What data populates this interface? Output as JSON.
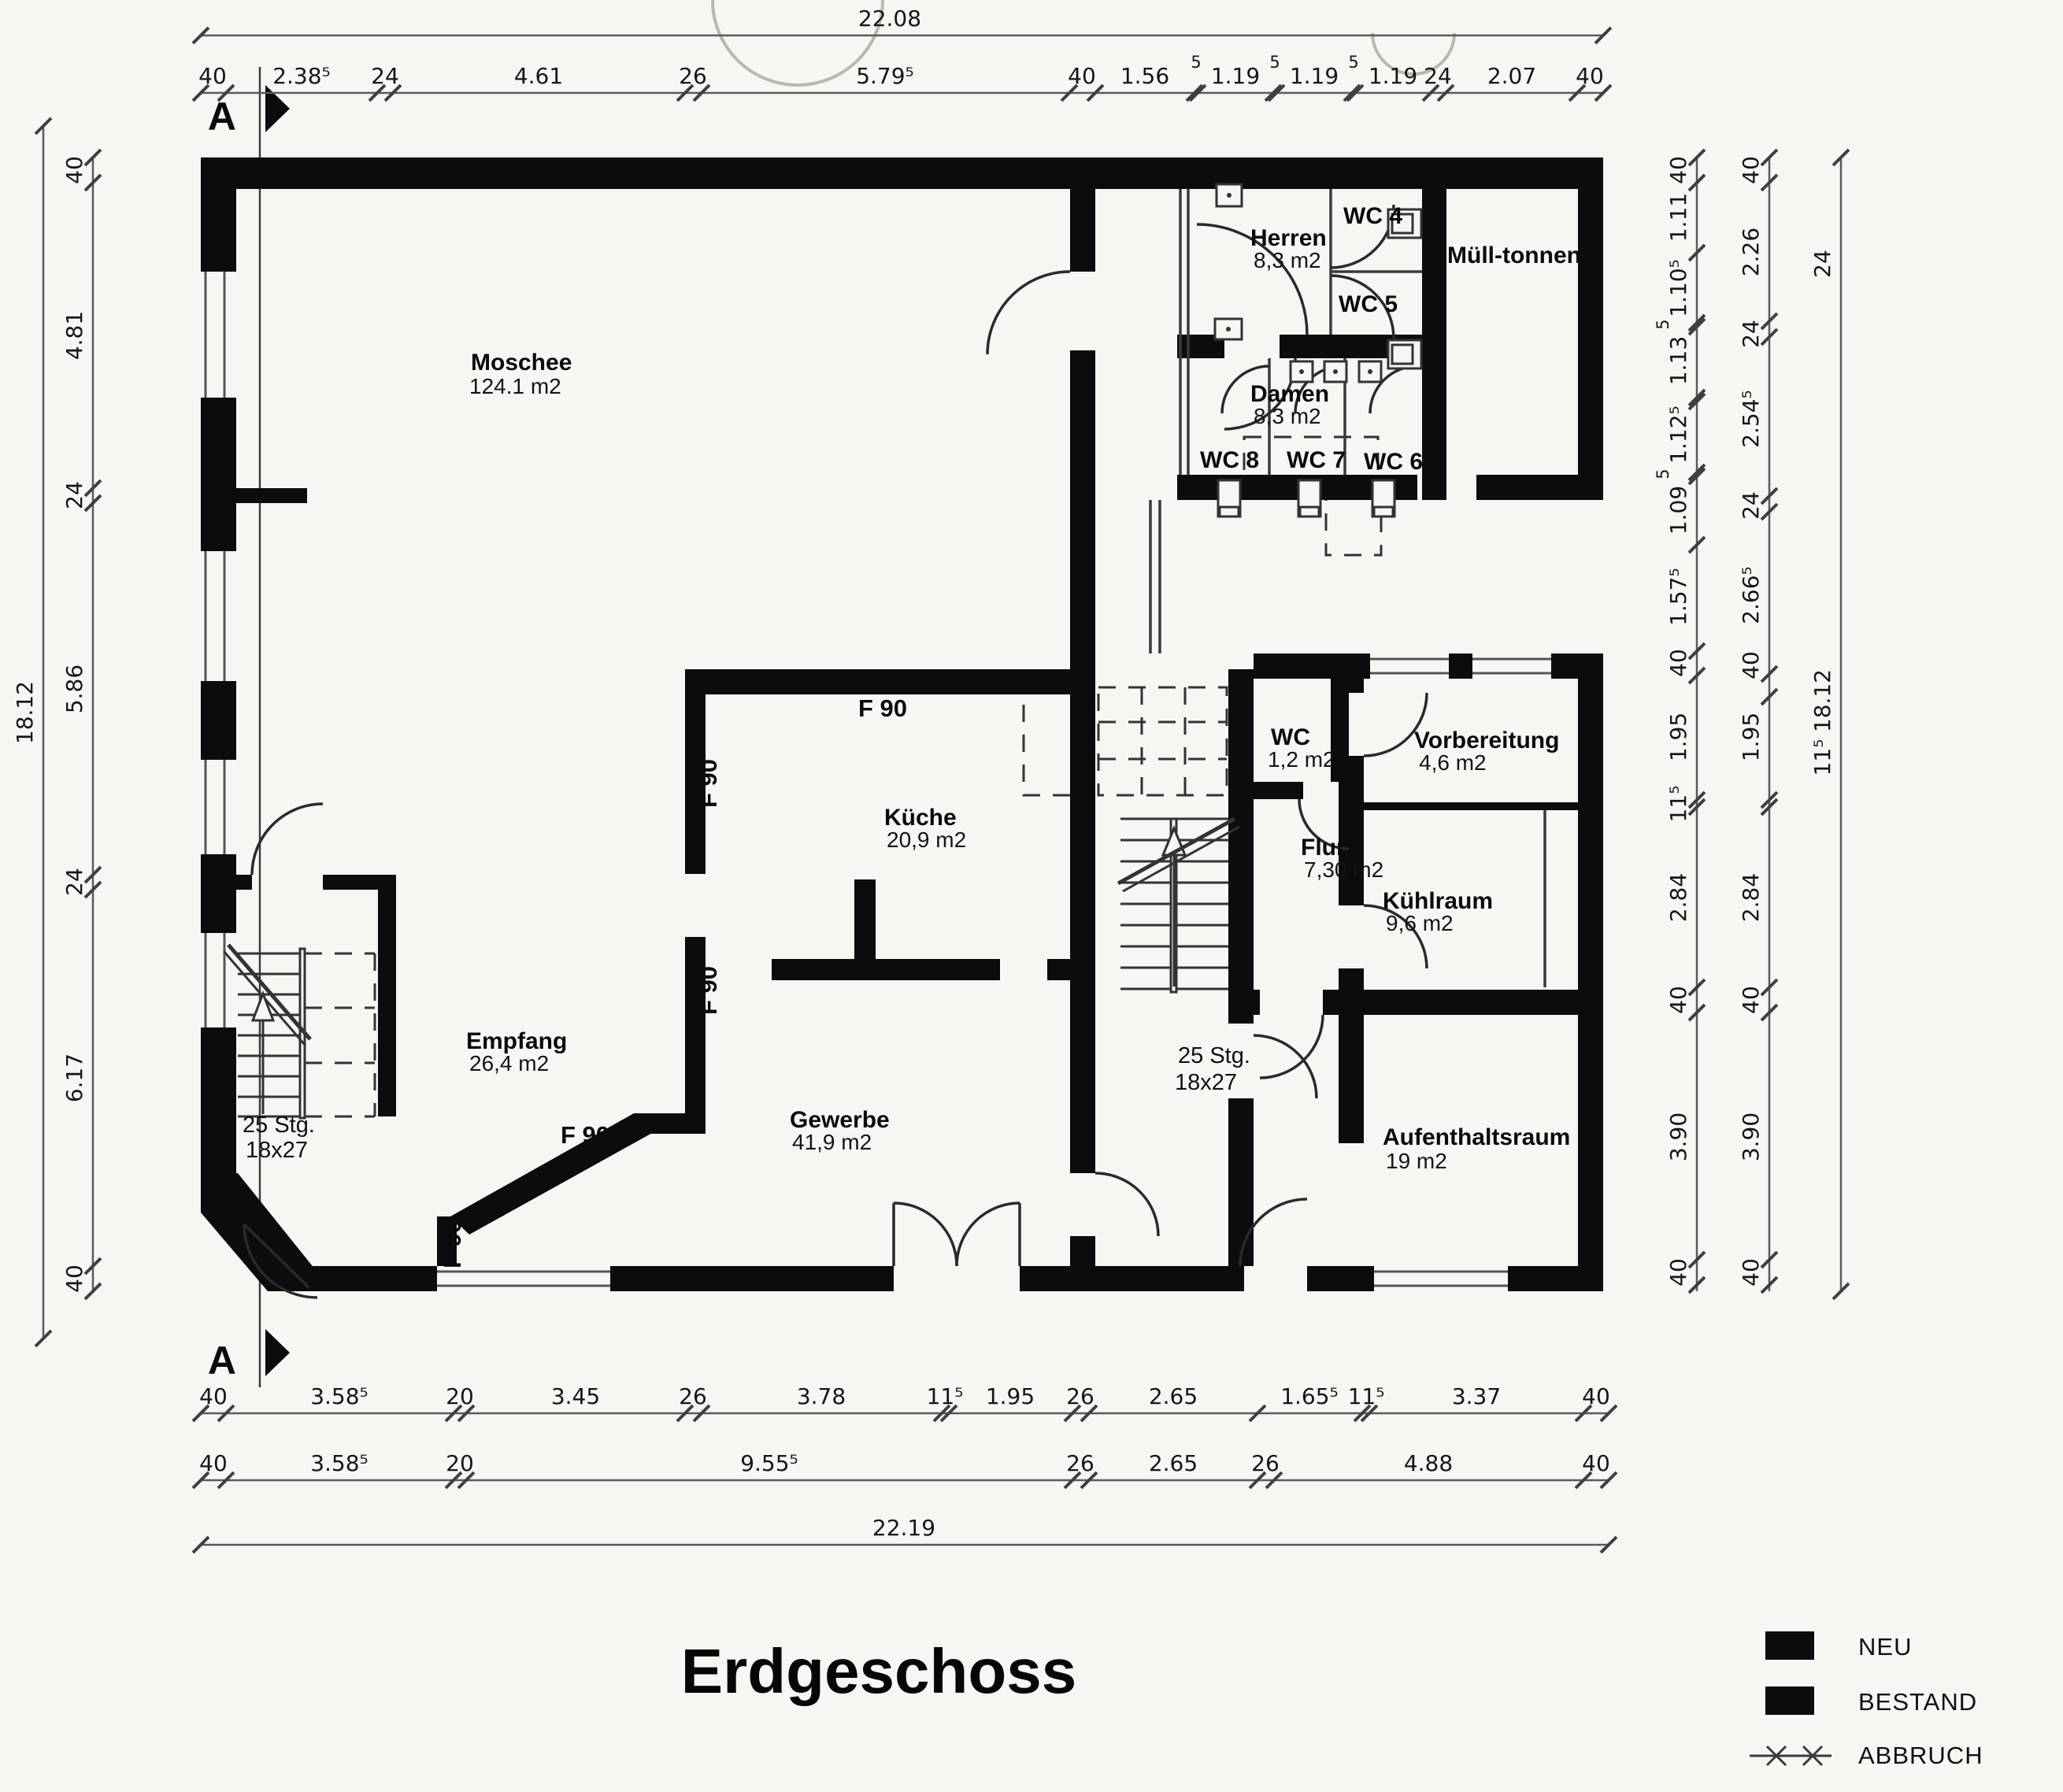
{
  "plan_title": "Erdgeschoss",
  "section_marker": {
    "label": "A"
  },
  "rooms": {
    "moschee": {
      "name": "Moschee",
      "area": "124.1 m2"
    },
    "herren": {
      "name": "Herren",
      "area": "8,3 m2"
    },
    "wc4": {
      "name": "WC 4"
    },
    "wc5": {
      "name": "WC 5"
    },
    "muelltonnen": {
      "name": "Müll-tonnen"
    },
    "damen": {
      "name": "Damen",
      "area": "8,3 m2"
    },
    "wc8": {
      "name": "WC 8"
    },
    "wc7": {
      "name": "WC 7"
    },
    "wc6": {
      "name": "WC 6"
    },
    "kueche": {
      "name": "Küche",
      "area": "20,9 m2"
    },
    "wc": {
      "name": "WC",
      "area": "1,2 m2"
    },
    "flur": {
      "name": "Flur",
      "area": "7,30 m2"
    },
    "vorbereitung": {
      "name": "Vorbereitung",
      "area": "4,6 m2"
    },
    "kuehlraum": {
      "name": "Kühlraum",
      "area": "9,6 m2"
    },
    "aufenthaltsraum": {
      "name": "Aufenthaltsraum",
      "area": "19 m2"
    },
    "empfang": {
      "name": "Empfang",
      "area": "26,4 m2"
    },
    "gewerbe": {
      "name": "Gewerbe",
      "area": "41,9 m2"
    }
  },
  "stairs": {
    "label_steps": "25 Stg.",
    "label_size": "18x27"
  },
  "fire_rating": "F 90",
  "legend": {
    "neu": "NEU",
    "bestand": "BESTAND",
    "abbruch": "ABBRUCH"
  },
  "colors": {
    "wall": "#0c0c0c",
    "paper": "#f7f6f2"
  },
  "dim_chains": [
    {
      "id": "top-total",
      "dir": "h",
      "line": 45,
      "range": [
        255,
        2036
      ],
      "ticks": [
        255,
        2036
      ],
      "labels": [
        {
          "t": "22.08",
          "p": 1130
        }
      ]
    },
    {
      "id": "top-chain",
      "dir": "h",
      "line": 118,
      "range": [
        255,
        2036
      ],
      "ticks": [
        255,
        287,
        479,
        499,
        870,
        891,
        1358,
        1391,
        1517,
        1521,
        1617,
        1621,
        1717,
        1721,
        1817,
        1836,
        2003,
        2036
      ],
      "labels": [
        {
          "t": "40",
          "p": 270
        },
        {
          "t": "2.38⁵",
          "p": 383
        },
        {
          "t": "24",
          "p": 489
        },
        {
          "t": "4.61",
          "p": 684
        },
        {
          "t": "26",
          "p": 880
        },
        {
          "t": "5.79⁵",
          "p": 1124
        },
        {
          "t": "40",
          "p": 1374
        },
        {
          "t": "1.56",
          "p": 1454
        },
        {
          "t": "5",
          "p": 1519,
          "small": 1
        },
        {
          "t": "1.19",
          "p": 1569
        },
        {
          "t": "5",
          "p": 1619,
          "small": 1
        },
        {
          "t": "1.19",
          "p": 1669
        },
        {
          "t": "5",
          "p": 1719,
          "small": 1
        },
        {
          "t": "1.19",
          "p": 1769
        },
        {
          "t": "24",
          "p": 1826
        },
        {
          "t": "2.07",
          "p": 1920
        },
        {
          "t": "40",
          "p": 2019
        }
      ]
    },
    {
      "id": "bottom-chain-1",
      "dir": "h",
      "line": 1795,
      "range": [
        255,
        2043
      ],
      "ticks": [
        255,
        287,
        576,
        592,
        870,
        891,
        1196,
        1205,
        1362,
        1383,
        1597,
        1730,
        1739,
        2011,
        2043
      ],
      "labels": [
        {
          "t": "40",
          "p": 271
        },
        {
          "t": "3.58⁵",
          "p": 431
        },
        {
          "t": "20",
          "p": 584
        },
        {
          "t": "3.45",
          "p": 731
        },
        {
          "t": "26",
          "p": 880
        },
        {
          "t": "3.78",
          "p": 1043
        },
        {
          "t": "11⁵",
          "p": 1200
        },
        {
          "t": "1.95",
          "p": 1283
        },
        {
          "t": "26",
          "p": 1372
        },
        {
          "t": "2.65",
          "p": 1490
        },
        {
          "t": "1.65⁵",
          "p": 1663
        },
        {
          "t": "11⁵",
          "p": 1735
        },
        {
          "t": "3.37",
          "p": 1875
        },
        {
          "t": "40",
          "p": 2027
        }
      ]
    },
    {
      "id": "bottom-chain-2",
      "dir": "h",
      "line": 1880,
      "range": [
        255,
        2043
      ],
      "ticks": [
        255,
        287,
        576,
        592,
        1362,
        1383,
        1597,
        1618,
        2011,
        2043
      ],
      "labels": [
        {
          "t": "40",
          "p": 271
        },
        {
          "t": "3.58⁵",
          "p": 431
        },
        {
          "t": "20",
          "p": 584
        },
        {
          "t": "9.55⁵",
          "p": 977
        },
        {
          "t": "26",
          "p": 1372
        },
        {
          "t": "2.65",
          "p": 1490
        },
        {
          "t": "26",
          "p": 1607
        },
        {
          "t": "4.88",
          "p": 1814
        },
        {
          "t": "40",
          "p": 2027
        }
      ]
    },
    {
      "id": "bottom-total",
      "dir": "h",
      "line": 1962,
      "range": [
        255,
        2043
      ],
      "ticks": [
        255,
        2043
      ],
      "labels": [
        {
          "t": "22.19",
          "p": 1148
        }
      ]
    },
    {
      "id": "left-chain",
      "dir": "v",
      "line": 118,
      "range": [
        200,
        1640
      ],
      "ticks": [
        200,
        232,
        620,
        639,
        1111,
        1130,
        1608,
        1640
      ],
      "labels": [
        {
          "t": "40",
          "p": 216
        },
        {
          "t": "4.81",
          "p": 426
        },
        {
          "t": "24",
          "p": 629
        },
        {
          "t": "5.86",
          "p": 875
        },
        {
          "t": "24",
          "p": 1120
        },
        {
          "t": "6.17",
          "p": 1369
        },
        {
          "t": "40",
          "p": 1624
        }
      ]
    },
    {
      "id": "left-total",
      "dir": "v",
      "line": 55,
      "range": [
        160,
        1700
      ],
      "ticks": [
        160,
        1700
      ],
      "labels": [
        {
          "t": "18.12",
          "p": 905
        }
      ]
    },
    {
      "id": "right-chain-1",
      "dir": "v",
      "line": 2155,
      "range": [
        200,
        1640
      ],
      "ticks": [
        200,
        232,
        321,
        410,
        415,
        505,
        510,
        600,
        605,
        692,
        827,
        858,
        1016,
        1025,
        1254,
        1286,
        1600,
        1632
      ],
      "labels": [
        {
          "t": "40",
          "p": 216
        },
        {
          "t": "1.11",
          "p": 276
        },
        {
          "t": "1.10⁵",
          "p": 366
        },
        {
          "t": "5",
          "p": 412,
          "small": 1
        },
        {
          "t": "1.13",
          "p": 458
        },
        {
          "t": "1.12⁵",
          "p": 552
        },
        {
          "t": "5",
          "p": 602,
          "small": 1
        },
        {
          "t": "1.09",
          "p": 648
        },
        {
          "t": "1.57⁵",
          "p": 758
        },
        {
          "t": "40",
          "p": 842
        },
        {
          "t": "1.95",
          "p": 936
        },
        {
          "t": "11⁵",
          "p": 1021
        },
        {
          "t": "2.84",
          "p": 1140
        },
        {
          "t": "40",
          "p": 1270
        },
        {
          "t": "3.90",
          "p": 1444
        },
        {
          "t": "40",
          "p": 1616
        }
      ]
    },
    {
      "id": "right-chain-2",
      "dir": "v",
      "line": 2247,
      "range": [
        200,
        1640
      ],
      "ticks": [
        200,
        232,
        408,
        428,
        630,
        650,
        856,
        885,
        1016,
        1025,
        1254,
        1286,
        1600,
        1632
      ],
      "labels": [
        {
          "t": "40",
          "p": 216
        },
        {
          "t": "2.26",
          "p": 320
        },
        {
          "t": "24",
          "p": 424
        },
        {
          "t": "2.54⁵",
          "p": 532
        },
        {
          "t": "24",
          "p": 642
        },
        {
          "t": "2.66⁵",
          "p": 756
        },
        {
          "t": "40",
          "p": 845
        },
        {
          "t": "1.95",
          "p": 936
        },
        {
          "t": "2.84",
          "p": 1140
        },
        {
          "t": "40",
          "p": 1270
        },
        {
          "t": "3.90",
          "p": 1444
        },
        {
          "t": "40",
          "p": 1616
        }
      ]
    },
    {
      "id": "right-chain-3",
      "dir": "v",
      "line": 2338,
      "range": [
        200,
        1640
      ],
      "ticks": [
        200,
        1640
      ],
      "labels": [
        {
          "t": "24",
          "p": 335
        },
        {
          "t": "18.12",
          "p": 890
        },
        {
          "t": "11⁵",
          "p": 962
        }
      ]
    }
  ]
}
